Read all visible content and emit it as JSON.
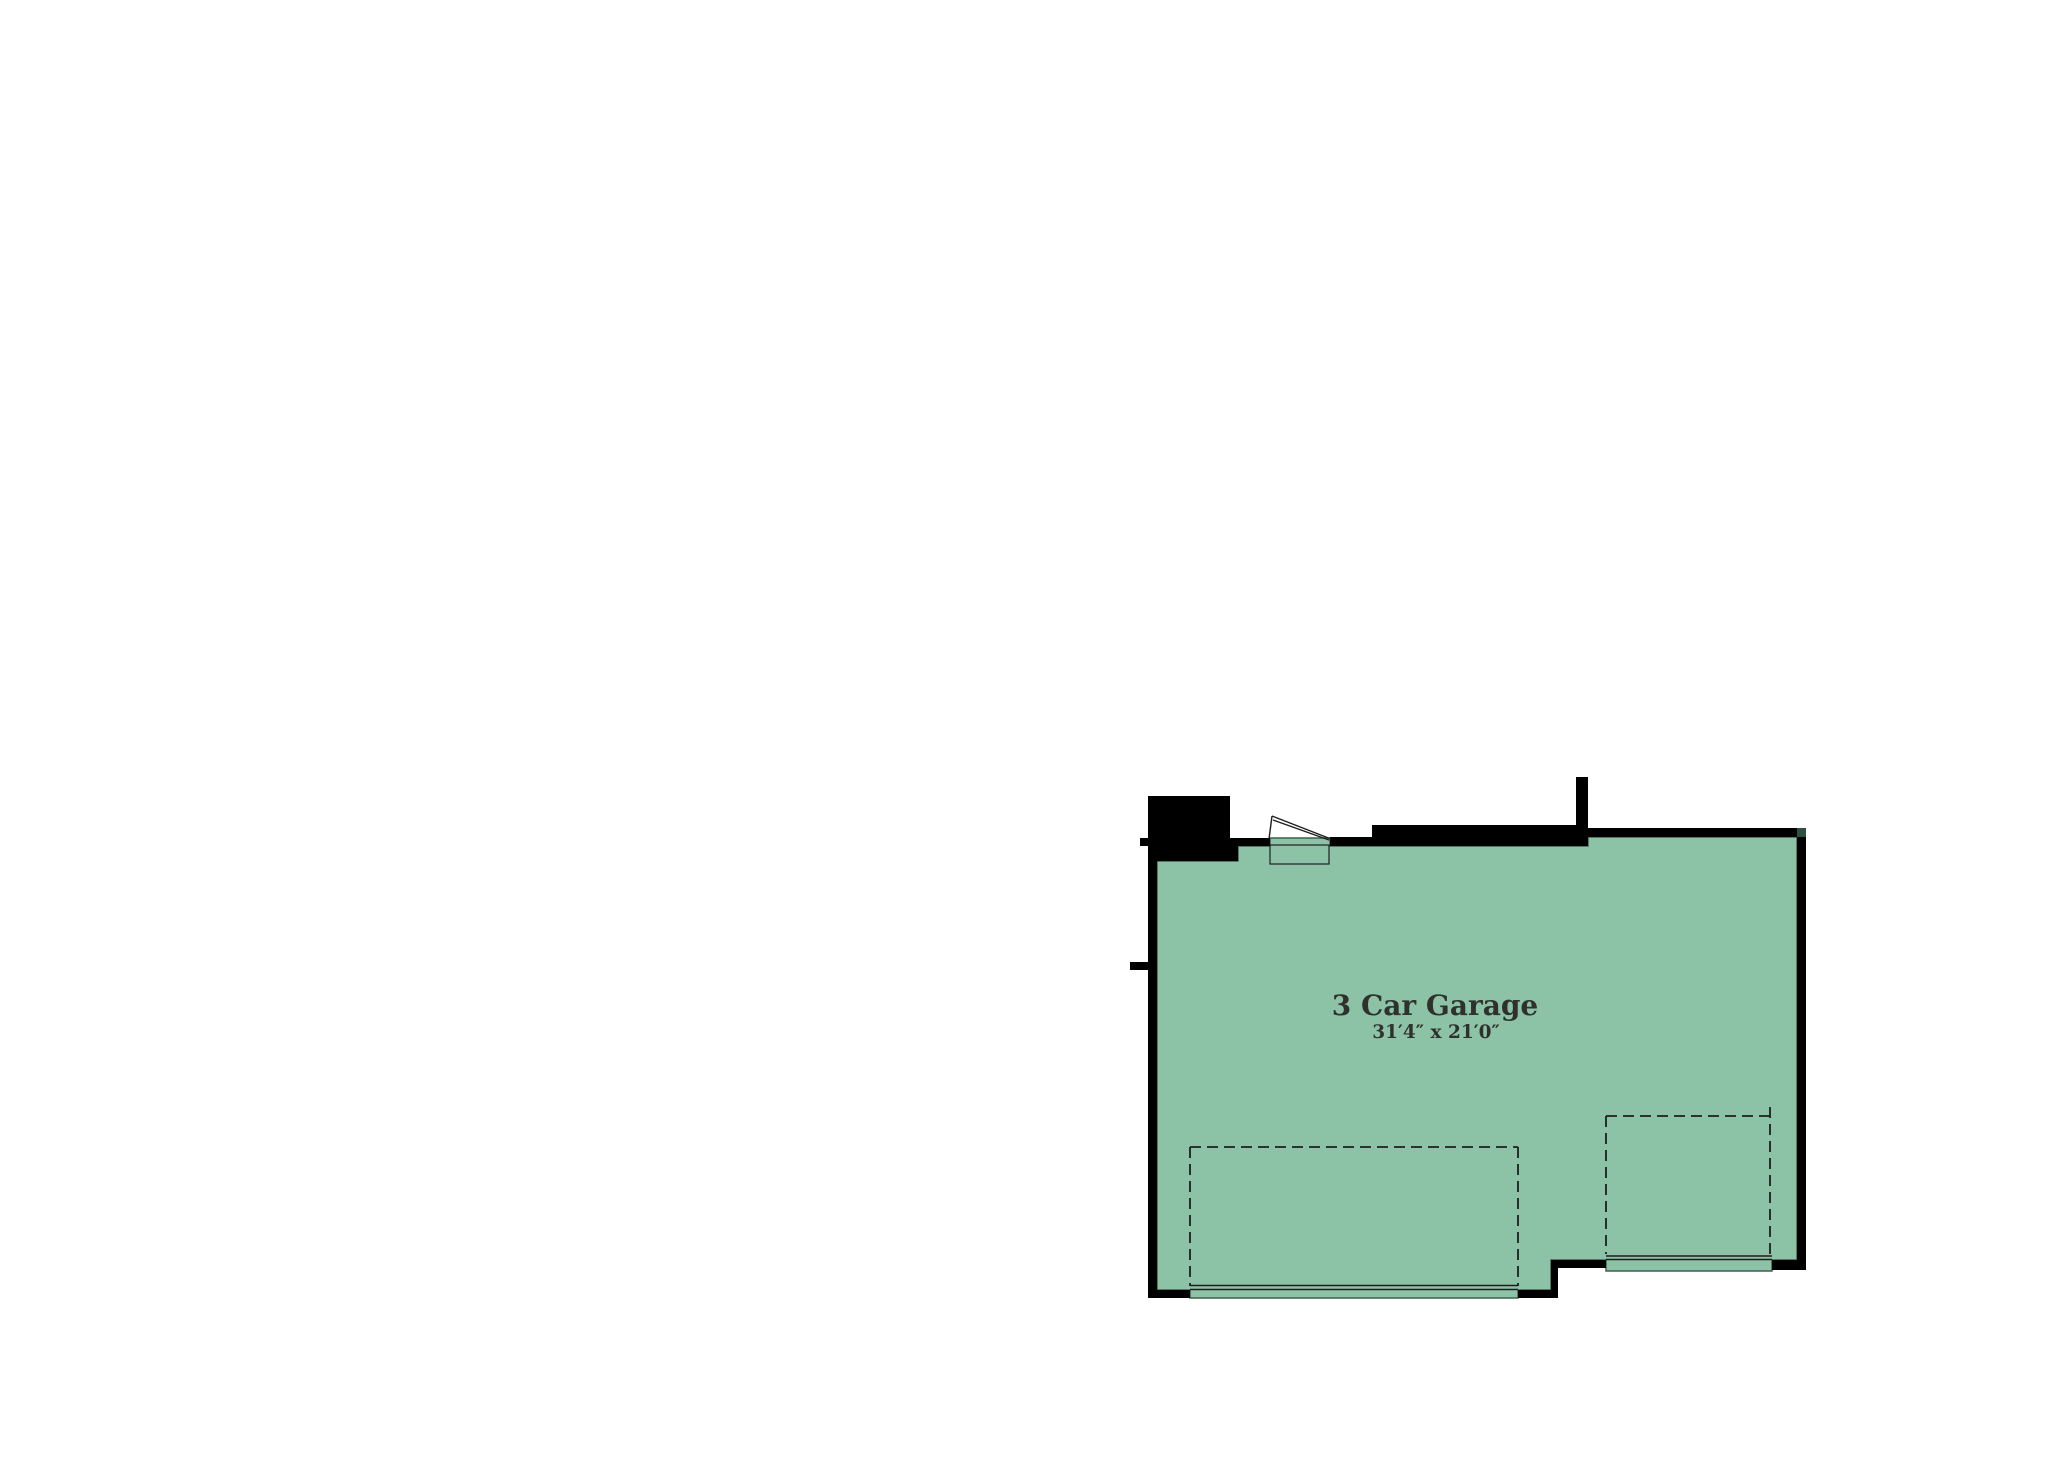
{
  "page": {
    "background": "#ffffff"
  },
  "colors": {
    "wall": "#000000",
    "room_fill": "#8cc3a7",
    "room_outline": "#3f614f",
    "corner_notch": "#2f4f3f",
    "thin_line": "#1e1e1e",
    "text": "#30312c"
  },
  "room": {
    "label": "3 Car Garage",
    "dimensions": "31′4″ x 21′0″"
  }
}
